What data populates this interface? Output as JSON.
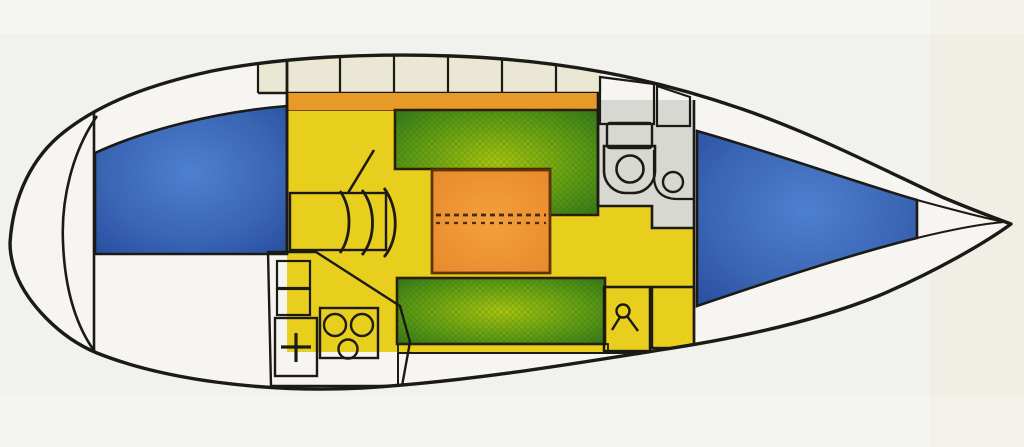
{
  "meta": {
    "diagram_type": "sailboat-interior-deck-plan",
    "description": "Top-view accommodation plan of a sailing yacht: pointed bow to the right with V-berth, head compartment with sea toilet and washbasin forward, central saloon with two green settees and orange folding table, galley with sink and two-burner stove aft-starboard, double berth in the rounded aft cabin to the left, coachroof locker row along the top side deck."
  },
  "palette": {
    "background": "#f1f1ee",
    "paperStreak": "#efe8d0",
    "hullInterior": "#f6f5f1",
    "outline": "#1c1a15",
    "coachroofLocker": "#eae7d5",
    "sideDeckOrange": "#e89a28",
    "saloonFloorYellow": "#e9cf1d",
    "setteeGreenDark": "#2c731c",
    "setteeGreenMid": "#5f9c14",
    "setteeGreenLight": "#a8c40f",
    "tableOrangeLight": "#f2a03e",
    "tableOrangeDark": "#e8882a",
    "tableOutline": "#5f3208",
    "berthBlueDark": "#26499c",
    "berthBlueMid": "#3a66b4",
    "berthBlueLight": "#4e80cf",
    "wetAreaGray": "#d8d8d3",
    "fixtureWhite": "#e9e9e4",
    "backrestCream": "#ebe7d0",
    "footStripBrown": "#b06a28",
    "foldLineBrown": "#4a2a08"
  },
  "regions": {
    "hull": "hull outline",
    "stern_locker": "stern locker crescent",
    "aft_cabin_berth": "aft cabin double berth",
    "saloon_floor": "saloon cabin sole",
    "coachroof_lockers": "coachroof locker row",
    "side_deck_strip": "side deck strip",
    "port_settee": "port settee",
    "starboard_settee": "starboard settee",
    "saloon_table": "folding saloon table",
    "cabin_door": "aft cabin folding door",
    "galley": "galley",
    "galley_sink": "galley sink",
    "galley_stove": "two-burner stove",
    "head_compartment": "head compartment",
    "toilet": "sea toilet",
    "washbasin": "washbasin",
    "chart_lockers": "aft equipment lockers",
    "v_berth": "forward V-berth"
  }
}
